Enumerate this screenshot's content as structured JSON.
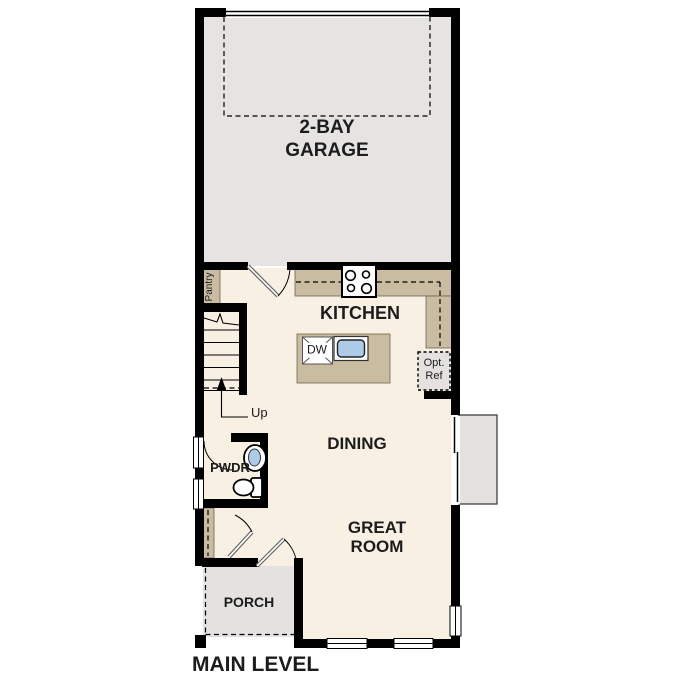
{
  "plan": {
    "title": "MAIN LEVEL",
    "rooms": {
      "garage": {
        "line1": "2-BAY",
        "line2": "GARAGE"
      },
      "kitchen": {
        "label": "KITCHEN"
      },
      "dining": {
        "label": "DINING"
      },
      "great_room": {
        "line1": "GREAT",
        "line2": "ROOM"
      },
      "porch": {
        "label": "PORCH"
      },
      "powder": {
        "label": "PWDR"
      },
      "pantry": {
        "label": "Pantry"
      }
    },
    "annotations": {
      "stairs_direction": "Up",
      "dishwasher": "DW",
      "opt_ref_line1": "Opt.",
      "opt_ref_line2": "Ref"
    },
    "colors": {
      "wall": "#000000",
      "garage_floor": "#e5e4e2",
      "main_floor": "#f8f1e3",
      "counter": "#c9bca1",
      "porch_floor": "#e3e2e0",
      "sink_water": "#abcbe9",
      "background": "#ffffff"
    }
  }
}
